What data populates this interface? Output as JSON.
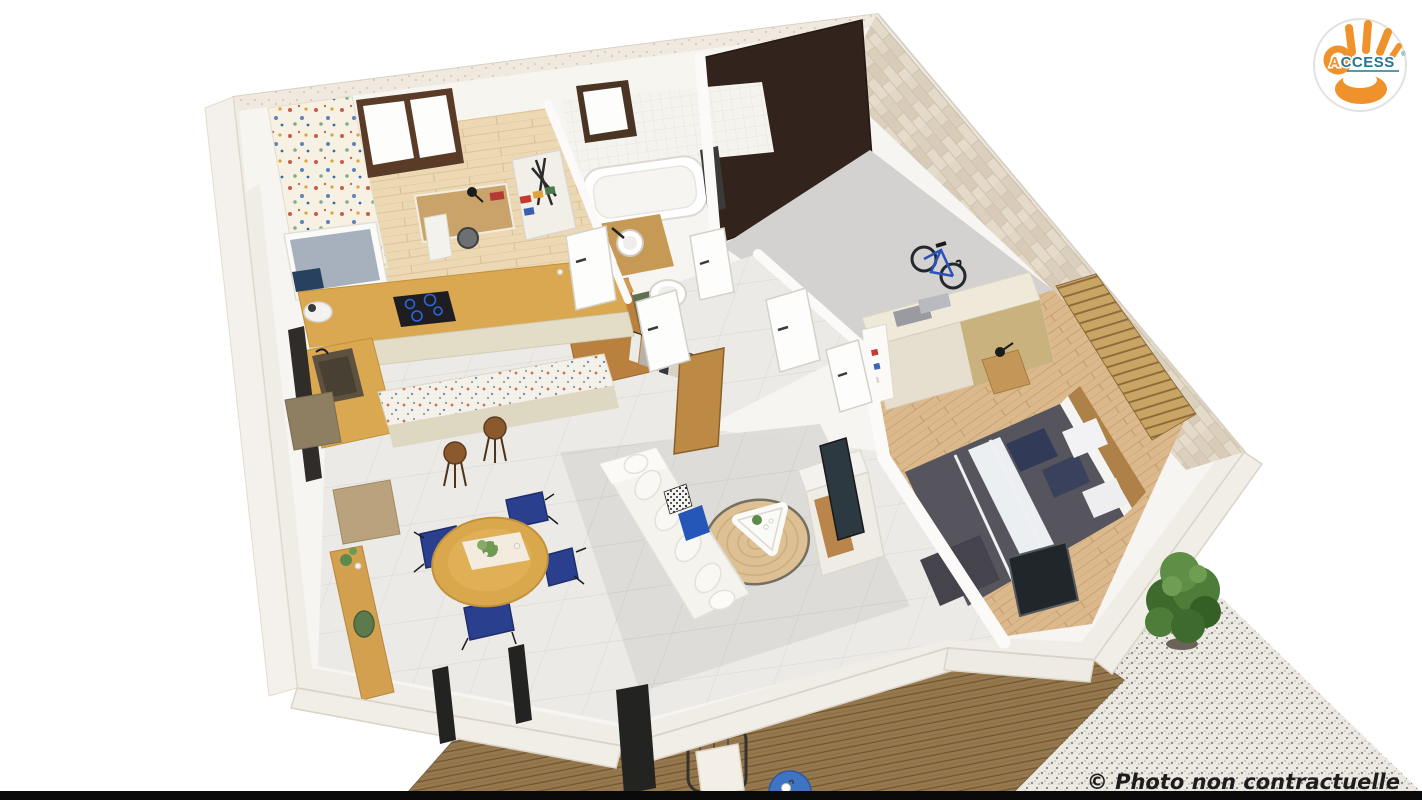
{
  "scene": {
    "type": "3d-floor-plan-render",
    "view": "aerial cutaway dollhouse view of a single-storey house with furnished rooms",
    "style": "photorealistic architectural visualization",
    "background": "#ffffff"
  },
  "branding": {
    "name": "ACCESS",
    "text_prefix": "A",
    "text_rest": "CCESS",
    "registered_mark": "®",
    "badge_shape": "white-circle",
    "hand_color": "#f0922b",
    "prefix_color": "#f0922b",
    "rest_color": "#27768e"
  },
  "watermark": {
    "text": "© Photo non contractuelle",
    "color": "#1d1d1d",
    "style": "bold-italic"
  },
  "rooms": [
    {
      "name": "kids-bedroom-office",
      "items": [
        "single bed with grey duvet and navy pillow",
        "floral wallpaper panel",
        "window with dark frame",
        "wooden desk",
        "black desk lamp",
        "desk chair"
      ]
    },
    {
      "name": "kitchen",
      "items": [
        "L-shaped wooden worktop",
        "black induction hob with blue rings",
        "dark sink",
        "cream cabinet fronts",
        "white food processor",
        "terrazzo breakfast bar",
        "2 wooden stools"
      ]
    },
    {
      "name": "bathroom",
      "items": [
        "white bathtub",
        "round vessel sink on wooden vanity",
        "small window",
        "white tiled wall",
        "dark radiator"
      ]
    },
    {
      "name": "wc",
      "items": [
        "white toilet",
        "green mat"
      ]
    },
    {
      "name": "storage-closet",
      "items": [
        "folded stroller",
        "shelf with colourful supplies"
      ]
    },
    {
      "name": "dressing",
      "items": [
        "open wooden wardrobe",
        "hanging clothes",
        "open wood door"
      ]
    },
    {
      "name": "garage",
      "items": [
        "dark brown garage door",
        "grey concrete floor",
        "travertine stone wall",
        "blue road bike"
      ]
    },
    {
      "name": "master-bedroom",
      "items": [
        "double bed with charcoal duvet and white stripes",
        "navy and white pillows",
        "sliding-door wardrobe with folded towels",
        "nightstand with black lamp",
        "wood slat feature wall",
        "dark window"
      ]
    },
    {
      "name": "living-room",
      "items": [
        "white corner sofa",
        "navy pillow",
        "black-white patterned pillow",
        "round jute rug",
        "white coffee table with plant",
        "TV on white-wood sideboard"
      ]
    },
    {
      "name": "dining-area",
      "items": [
        "round wooden table with flowers",
        "4 navy upholstered chairs",
        "wooden sideboard with green plate",
        "beige doormat"
      ]
    },
    {
      "name": "terrace",
      "items": [
        "diagonal wood plank deck",
        "black wire armchair with white cushion",
        "blue round side table with cup"
      ]
    },
    {
      "name": "patio",
      "items": [
        "speckled gravel ground",
        "green shrub",
        "grey wall block"
      ]
    }
  ],
  "palette": {
    "wall": "#f0ede7",
    "stone_crest": "#e7dfd1",
    "travertine": "#e0d6c5",
    "wood_floor_light": "#ecd9b4",
    "wood_floor_mid": "#dcb98c",
    "wood_furniture": "#d9a84c",
    "tile_floor": "#eceae6",
    "grey_tile": "#dcdad6",
    "concrete": "#d4d2d0",
    "deck": "#96784f",
    "gravel": "#ebe9e2",
    "navy": "#2b3f8f",
    "blue_accent": "#3f74c4",
    "duvet_grey": "#56555e",
    "plant_green": "#4e7c39",
    "garage_door": "#32231c",
    "black_bar": "#0a0a0a"
  }
}
